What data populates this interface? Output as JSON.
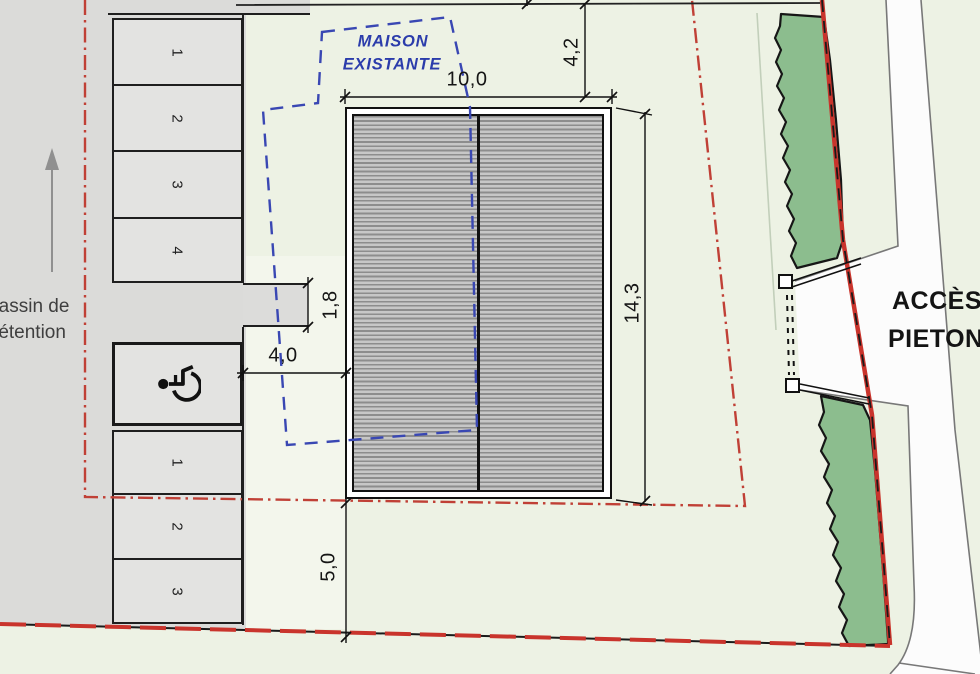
{
  "plan": {
    "existing_house_label": {
      "line1": "MAISON",
      "line2": "EXISTANTE"
    },
    "basin_label": {
      "line1": "Bassin de",
      "line2": "rétention"
    },
    "access_label": {
      "line1": "ACCÈS",
      "line2": "PIETON"
    },
    "dimensions": {
      "building_width": "10,0",
      "front_setback": "4,2",
      "building_depth": "14,3",
      "walkway_width": "1,8",
      "side_gap": "4,0",
      "rear_setback": "5,0"
    },
    "parking": {
      "upper_spaces": [
        "1",
        "2",
        "3",
        "4"
      ],
      "lower_spaces": [
        "1",
        "2",
        "3"
      ]
    },
    "icons": {
      "handicap_space": "wheelchair-icon",
      "orientation_arrow": "up-arrow-icon"
    },
    "colors": {
      "boundary_red": "#c9342c",
      "house_outline_blue": "#3947b3",
      "hedge_green": "#8cbd8e",
      "plot_green": "#edf2e4",
      "road_gray": "#dbdbd9"
    }
  }
}
